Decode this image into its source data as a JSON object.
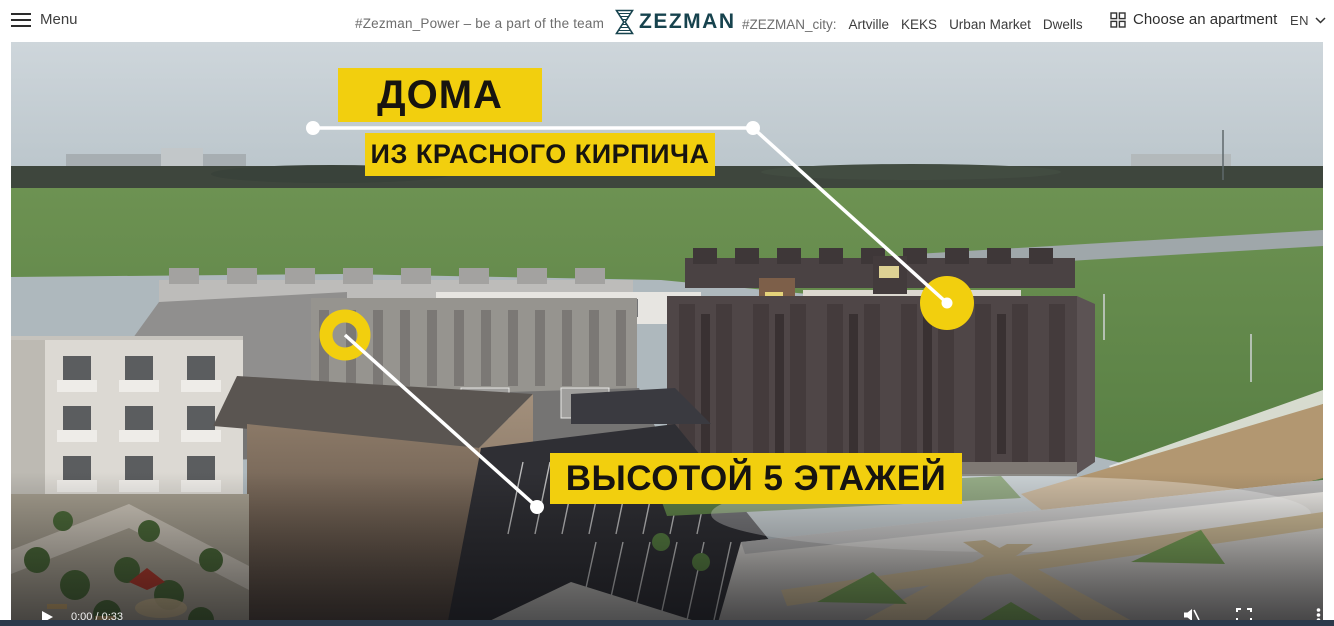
{
  "header": {
    "menu": {
      "label": "Menu"
    },
    "tagline": "#Zezman_Power – be a part of the team",
    "logo": {
      "text": "ZEZMAN"
    },
    "city": {
      "label": "#ZEZMAN_city:",
      "links": [
        {
          "label": "Artville"
        },
        {
          "label": "KEKS"
        },
        {
          "label": "Urban Market"
        },
        {
          "label": "Dwells"
        }
      ]
    },
    "choose_apartment": {
      "label": "Choose an apartment"
    },
    "language": {
      "code": "EN"
    }
  },
  "video": {
    "labels": {
      "houses_title": "ДОМА",
      "houses_subtitle": "ИЗ КРАСНОГО КИРПИЧА",
      "height_label": "ВЫСОТОЙ 5 ЭТАЖЕЙ"
    },
    "controls": {
      "time": "0:00 / 0:33"
    },
    "colors": {
      "label_bg": "#F2CF0E",
      "label_text": "#171410",
      "marker_yellow": "#F2CF0E",
      "line_white": "#FFFFFF"
    }
  },
  "theme": {
    "brand": "#17434E",
    "accent": "#F2CF0E",
    "divider": "#2B3A4B"
  }
}
